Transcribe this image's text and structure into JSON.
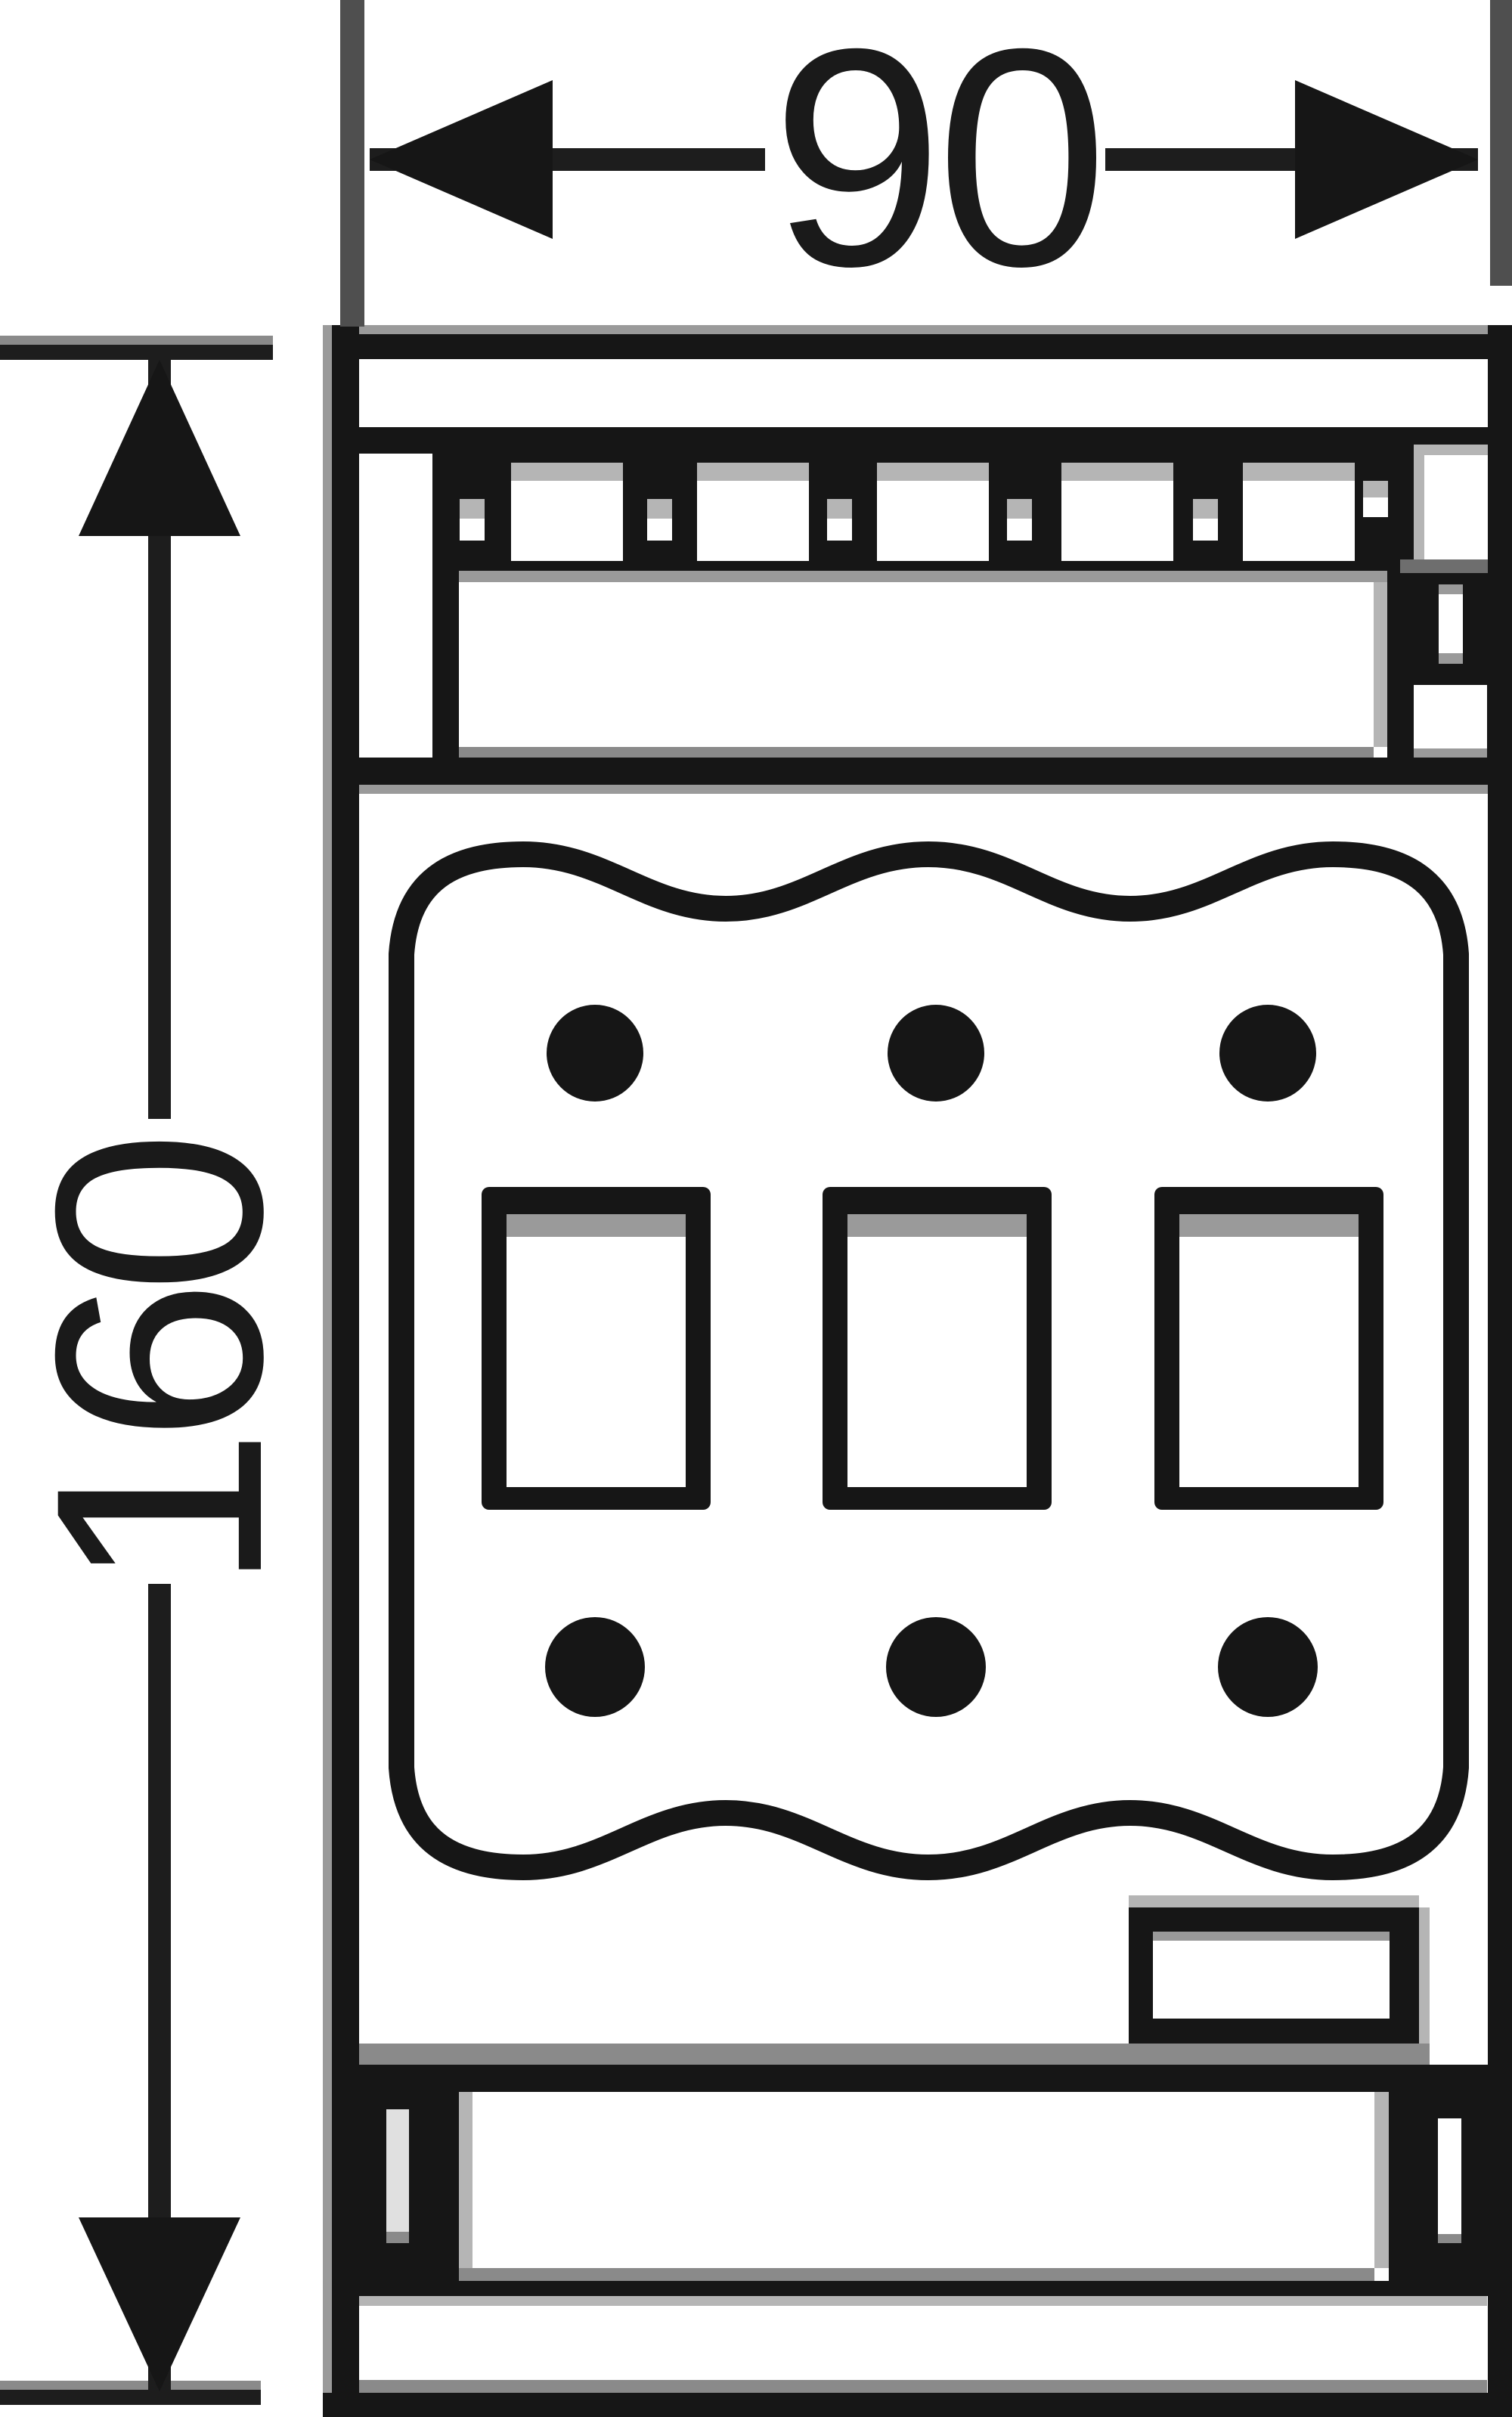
{
  "figure": {
    "type": "dimensioned-technical-drawing",
    "description": "Front view outline drawing of a 3-pole electrical device with terminal strip, wavy terminal-cover pad, three rectangular pole windows, six circular screw points and mounting-rail clips"
  },
  "dimensions": {
    "width": {
      "label": "90"
    },
    "height": {
      "label": "160"
    }
  },
  "colors": {
    "ink": "#161616",
    "extension_line": "#4f4f4f",
    "edge_highlight": "#9a9a9a",
    "paper": "#ffffff"
  }
}
